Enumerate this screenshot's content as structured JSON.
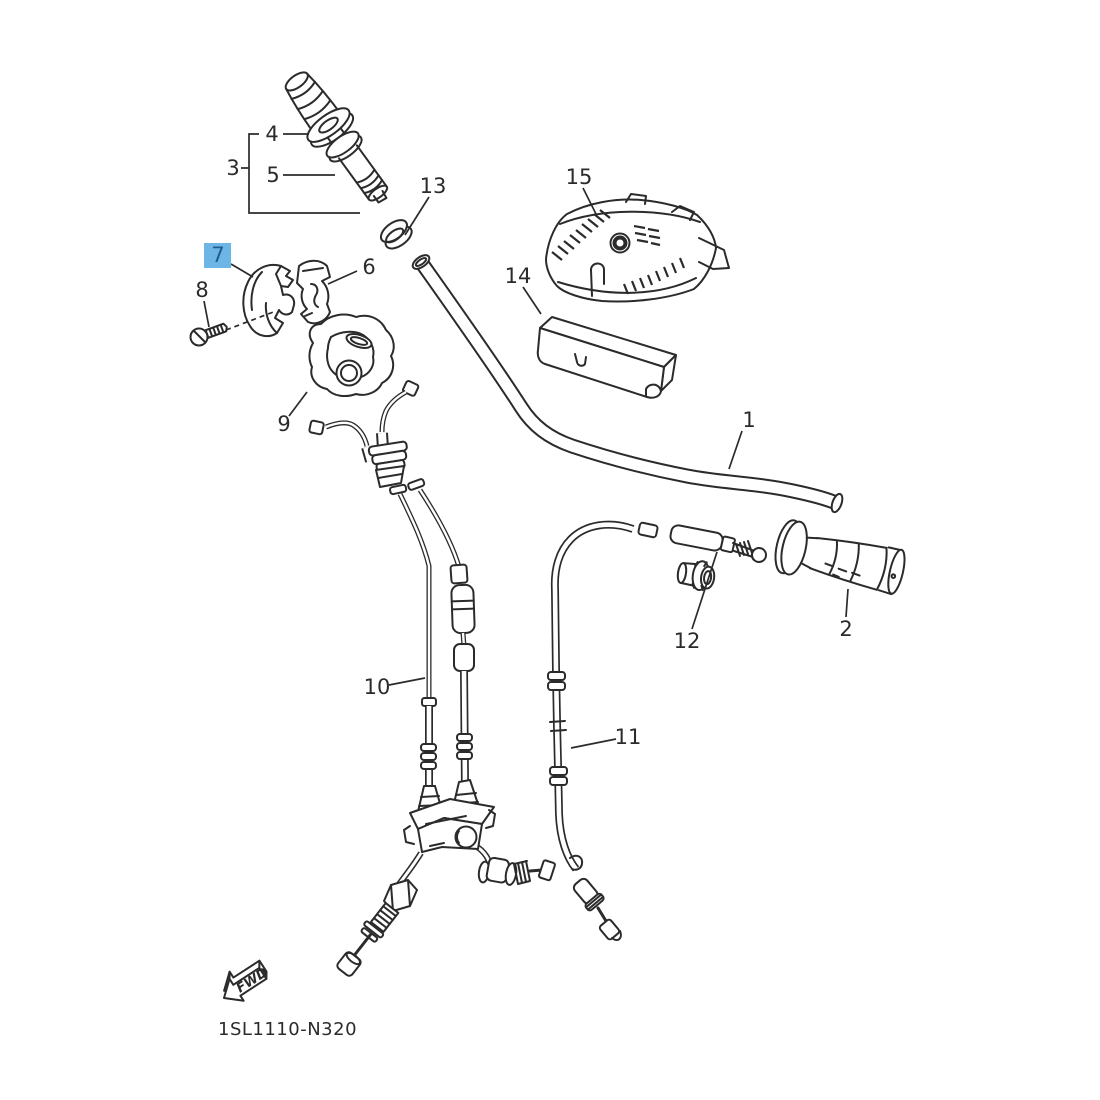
{
  "diagram": {
    "drawing_code": "1SL1110-N320",
    "fwd_label": "FWD",
    "highlighted_part": "7",
    "parts": {
      "1": "1",
      "2": "2",
      "3": "3",
      "4": "4",
      "5": "5",
      "6": "6",
      "7": "7",
      "8": "8",
      "9": "9",
      "10": "10",
      "11": "11",
      "12": "12",
      "13": "13",
      "14": "14",
      "15": "15"
    },
    "colors": {
      "line": "#2b2b2b",
      "highlight_bg": "#6cb5e4",
      "highlight_text": "#1f5c8f",
      "background": "#ffffff"
    }
  }
}
